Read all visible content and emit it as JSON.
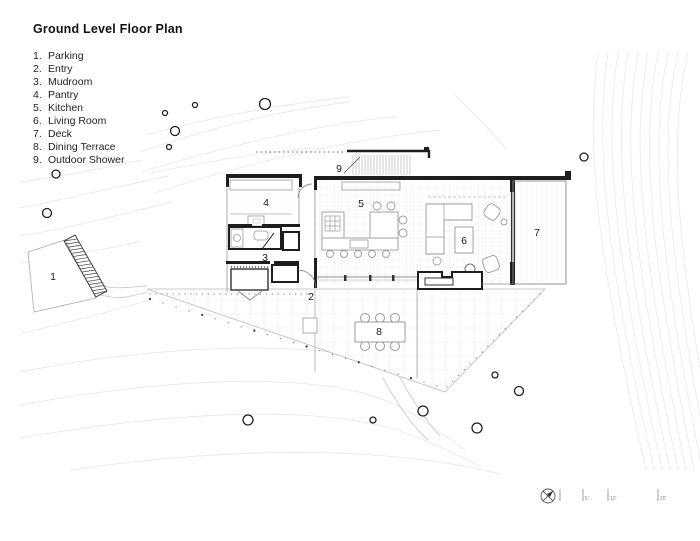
{
  "title": "Ground Level Floor Plan",
  "legend": [
    {
      "number": "1.",
      "label": "Parking"
    },
    {
      "number": "2.",
      "label": "Entry"
    },
    {
      "number": "3.",
      "label": "Mudroom"
    },
    {
      "number": "4.",
      "label": "Pantry"
    },
    {
      "number": "5.",
      "label": "Kitchen"
    },
    {
      "number": "6.",
      "label": "Living Room"
    },
    {
      "number": "7.",
      "label": "Deck"
    },
    {
      "number": "8.",
      "label": "Dining Terrace"
    },
    {
      "number": "9.",
      "label": "Outdoor Shower"
    }
  ],
  "plan": {
    "room_labels": [
      {
        "number": "1",
        "name": "Parking"
      },
      {
        "number": "2",
        "name": "Entry"
      },
      {
        "number": "3",
        "name": "Mudroom"
      },
      {
        "number": "4",
        "name": "Pantry"
      },
      {
        "number": "5",
        "name": "Kitchen"
      },
      {
        "number": "6",
        "name": "Living Room"
      },
      {
        "number": "7",
        "name": "Deck"
      },
      {
        "number": "8",
        "name": "Dining Terrace"
      },
      {
        "number": "9",
        "name": "Outdoor Shower"
      }
    ]
  },
  "scale_bar": {
    "tick_labels": [
      "5'",
      "10'",
      "20'"
    ],
    "compass": "north-arrow"
  },
  "colors": {
    "wall": "#1d1d1d",
    "furniture": "#999999",
    "contour": "#e8e8e8",
    "terrace_outline": "#bbbbbb",
    "dots": "#777777"
  }
}
